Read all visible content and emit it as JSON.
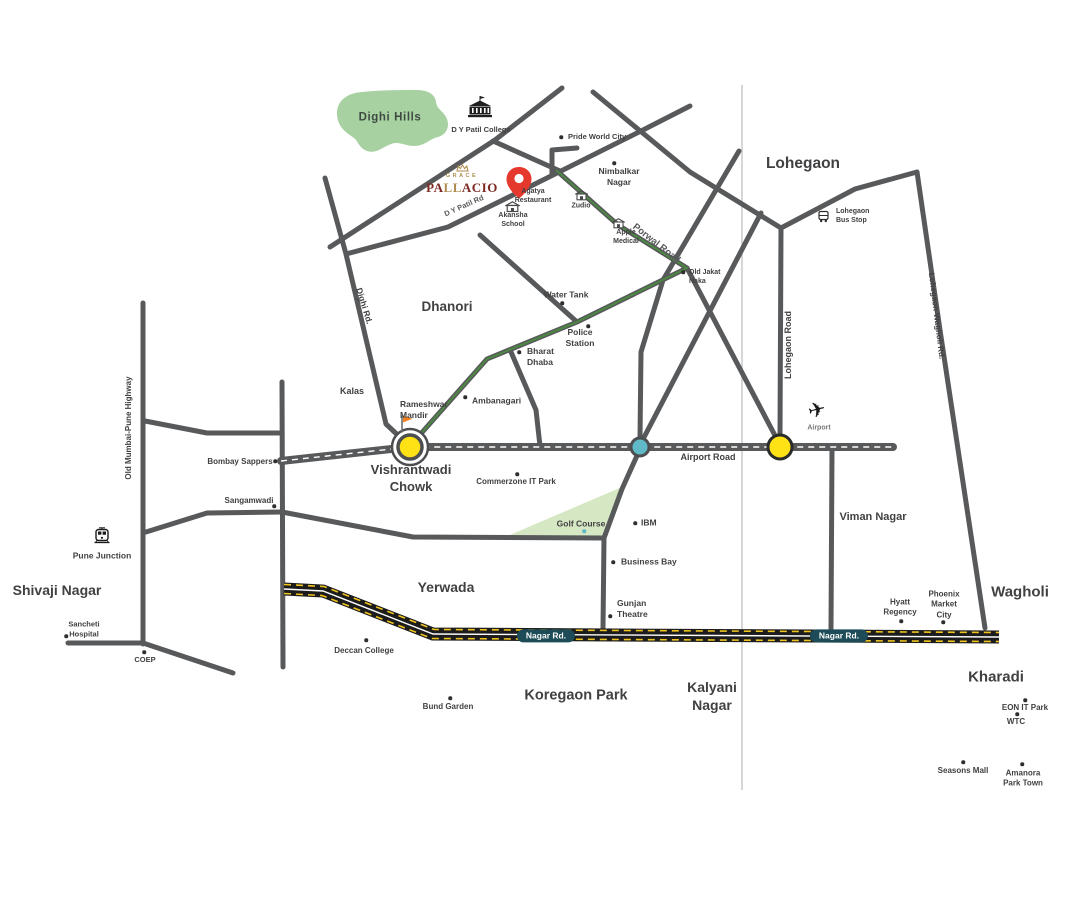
{
  "map": {
    "theme": {
      "road": "#58595b",
      "ink": "#414042",
      "green": "#4a8c3f",
      "hills": "#a8d1a2",
      "golf": "#d5e7c3",
      "yellow": "#ffe215",
      "teal": "#5fb9c6",
      "hwy": "#1c1c1c",
      "hwyellow": "#efc41c",
      "badge": "#1d4b57",
      "pin": "#e6392e",
      "flag": "#f5821f",
      "maroon": "#7d2a24",
      "gold": "#a98e4e"
    },
    "logo": {
      "top": "GRACE",
      "p1": "PA",
      "p2": "LL",
      "p3": "ACIO"
    },
    "labels": [
      {
        "id": "dighi-hills",
        "t": "Dighi Hills",
        "x": 390,
        "y": 118,
        "fz": 11.5,
        "fw": 700,
        "ls": 0.6,
        "c": "#3e4b42"
      },
      {
        "id": "lohegaon",
        "t": "Lohegaon",
        "x": 803,
        "y": 164,
        "fz": 15.5,
        "fw": 600
      },
      {
        "id": "dhanori",
        "t": "Dhanori",
        "x": 447,
        "y": 307,
        "fz": 13.5,
        "fw": 600
      },
      {
        "id": "vishrantwadi-chowk",
        "t": "Vishrantwadi\nChowk",
        "x": 411,
        "y": 479,
        "fz": 13,
        "fw": 700
      },
      {
        "id": "viman-nagar",
        "t": "Viman Nagar",
        "x": 873,
        "y": 517,
        "fz": 11,
        "fw": 700
      },
      {
        "id": "shivaji-nagar",
        "t": "Shivaji Nagar",
        "x": 57,
        "y": 590,
        "fz": 14,
        "fw": 600
      },
      {
        "id": "yerwada",
        "t": "Yerwada",
        "x": 446,
        "y": 587,
        "fz": 14,
        "fw": 600
      },
      {
        "id": "wagholi",
        "t": "Wagholi",
        "x": 1020,
        "y": 592,
        "fz": 15,
        "fw": 600
      },
      {
        "id": "koregaon-park",
        "t": "Koregaon Park",
        "x": 576,
        "y": 696,
        "fz": 14.5,
        "fw": 600
      },
      {
        "id": "kalyani-nagar",
        "t": "Kalyani\nNagar",
        "x": 712,
        "y": 696,
        "fz": 14,
        "fw": 600
      },
      {
        "id": "kharadi",
        "t": "Kharadi",
        "x": 996,
        "y": 677,
        "fz": 15,
        "fw": 600
      },
      {
        "id": "dy-patil-college",
        "t": "D Y Patil College",
        "x": 481,
        "y": 130,
        "fz": 7.5,
        "fw": 600
      },
      {
        "id": "pride-world-city",
        "t": "Pride World City",
        "x": 568,
        "y": 137,
        "fz": 7.5,
        "fw": 600,
        "a": "l",
        "dot": [
          561,
          137
        ]
      },
      {
        "id": "nimbalkar-nagar",
        "t": "Nimbalkar\nNagar",
        "x": 619,
        "y": 177,
        "fz": 8.5,
        "fw": 600,
        "dot": [
          614,
          163
        ]
      },
      {
        "id": "agatya-restaurant",
        "t": "Agatya\nRestaurant",
        "x": 533,
        "y": 196,
        "fz": 7,
        "fw": 600
      },
      {
        "id": "akansha-school",
        "t": "Akansha\nSchool",
        "x": 513,
        "y": 220,
        "fz": 7,
        "fw": 600
      },
      {
        "id": "zudio",
        "t": "Zudio",
        "x": 581,
        "y": 206,
        "fz": 7,
        "fw": 600
      },
      {
        "id": "apple-medical",
        "t": "Apple\nMedical",
        "x": 626,
        "y": 237,
        "fz": 7,
        "fw": 600
      },
      {
        "id": "lohegaon-bus-stop",
        "t": "Lohegaon\nBus Stop",
        "x": 836,
        "y": 216,
        "fz": 7,
        "fw": 600,
        "a": "l"
      },
      {
        "id": "old-jakat-naka",
        "t": "Old Jakat\nNaka",
        "x": 689,
        "y": 277,
        "fz": 7,
        "fw": 600,
        "a": "l",
        "dot": [
          683,
          272
        ]
      },
      {
        "id": "water-tank",
        "t": "Water Tank",
        "x": 566,
        "y": 295,
        "fz": 8.5,
        "fw": 600,
        "dot": [
          562,
          303
        ]
      },
      {
        "id": "police-station",
        "t": "Police\nStation",
        "x": 580,
        "y": 338,
        "fz": 8.5,
        "fw": 600,
        "dot": [
          588,
          326
        ]
      },
      {
        "id": "bharat-dhaba",
        "t": "Bharat\nDhaba",
        "x": 527,
        "y": 357,
        "fz": 8.5,
        "fw": 600,
        "a": "l",
        "dot": [
          519,
          352
        ]
      },
      {
        "id": "ambanagari",
        "t": "Ambanagari",
        "x": 472,
        "y": 401,
        "fz": 8.5,
        "fw": 600,
        "a": "l",
        "dot": [
          465,
          397
        ]
      },
      {
        "id": "rameshwar-mandir",
        "t": "Rameshwar\nMandir",
        "x": 400,
        "y": 410,
        "fz": 8.5,
        "fw": 600,
        "a": "l"
      },
      {
        "id": "kalas",
        "t": "Kalas",
        "x": 352,
        "y": 392,
        "fz": 9,
        "fw": 600
      },
      {
        "id": "bombay-sappers",
        "t": "Bombay Sappers",
        "x": 240,
        "y": 462,
        "fz": 8,
        "fw": 600,
        "dot": [
          275,
          461
        ]
      },
      {
        "id": "sangamwadi",
        "t": "Sangamwadi",
        "x": 249,
        "y": 501,
        "fz": 8,
        "fw": 600,
        "dot": [
          274,
          506
        ]
      },
      {
        "id": "pune-junction",
        "t": "Pune Junction",
        "x": 102,
        "y": 556,
        "fz": 8.5,
        "fw": 700
      },
      {
        "id": "sancheti-hospital",
        "t": "Sancheti\nHospital",
        "x": 84,
        "y": 629,
        "fz": 7.5,
        "fw": 600,
        "dot": [
          66,
          636
        ]
      },
      {
        "id": "coep",
        "t": "COEP",
        "x": 145,
        "y": 660,
        "fz": 7.5,
        "fw": 600,
        "dot": [
          144,
          652
        ]
      },
      {
        "id": "commerzone-it-park",
        "t": "Commerzone IT Park",
        "x": 516,
        "y": 482,
        "fz": 8,
        "fw": 600,
        "dot": [
          517,
          474
        ]
      },
      {
        "id": "golf-course",
        "t": "Golf Course",
        "x": 581,
        "y": 524,
        "fz": 8.5,
        "fw": 600,
        "dot": [
          584,
          531
        ],
        "dc": "#5fb9c6"
      },
      {
        "id": "ibm",
        "t": "IBM",
        "x": 641,
        "y": 523,
        "fz": 8.5,
        "fw": 600,
        "a": "l",
        "dot": [
          635,
          523
        ]
      },
      {
        "id": "business-bay",
        "t": "Business Bay",
        "x": 621,
        "y": 562,
        "fz": 8.5,
        "fw": 600,
        "a": "l",
        "dot": [
          613,
          562
        ]
      },
      {
        "id": "gunjan-theatre",
        "t": "Gunjan\nTheatre",
        "x": 617,
        "y": 609,
        "fz": 8.5,
        "fw": 600,
        "a": "l",
        "dot": [
          610,
          616
        ]
      },
      {
        "id": "airport",
        "t": "Airport",
        "x": 819,
        "y": 428,
        "fz": 7,
        "fw": 600,
        "c": "#77787b"
      },
      {
        "id": "hyatt-regency",
        "t": "Hyatt\nRegency",
        "x": 900,
        "y": 608,
        "fz": 8,
        "fw": 600,
        "dot": [
          901,
          621
        ]
      },
      {
        "id": "phoenix-market-city",
        "t": "Phoenix\nMarket\nCity",
        "x": 944,
        "y": 605,
        "fz": 8,
        "fw": 600,
        "dot": [
          943,
          622
        ]
      },
      {
        "id": "deccan-college",
        "t": "Deccan College",
        "x": 364,
        "y": 651,
        "fz": 8,
        "fw": 600,
        "dot": [
          366,
          640
        ]
      },
      {
        "id": "bund-garden",
        "t": "Bund Garden",
        "x": 448,
        "y": 707,
        "fz": 8,
        "fw": 600,
        "dot": [
          450,
          698
        ]
      },
      {
        "id": "eon-it-park",
        "t": "EON IT Park",
        "x": 1025,
        "y": 708,
        "fz": 8,
        "fw": 600,
        "dot": [
          1025,
          700
        ]
      },
      {
        "id": "wtc",
        "t": "WTC",
        "x": 1016,
        "y": 722,
        "fz": 8,
        "fw": 600,
        "dot": [
          1017,
          714
        ]
      },
      {
        "id": "seasons-mall",
        "t": "Seasons Mall",
        "x": 963,
        "y": 771,
        "fz": 8,
        "fw": 600,
        "dot": [
          963,
          762
        ]
      },
      {
        "id": "amanora-park-town",
        "t": "Amanora\nPark Town",
        "x": 1023,
        "y": 779,
        "fz": 8,
        "fw": 600,
        "dot": [
          1022,
          764
        ]
      },
      {
        "id": "road-dy-patil-rd",
        "t": "D Y Patil Rd",
        "x": 464,
        "y": 206,
        "fz": 7.5,
        "fw": 700,
        "rot": -24,
        "c": "#58595b"
      },
      {
        "id": "road-dighi-rd",
        "t": "Dighi Rd.",
        "x": 364,
        "y": 306,
        "fz": 8.5,
        "fw": 700,
        "rot": 73
      },
      {
        "id": "road-porwal",
        "t": "Porwal Road",
        "x": 656,
        "y": 244,
        "fz": 9.5,
        "fw": 700,
        "rot": 38,
        "c": "#58595b"
      },
      {
        "id": "road-airport",
        "t": "Airport Road",
        "x": 708,
        "y": 458,
        "fz": 9,
        "fw": 700
      },
      {
        "id": "road-lohegaon",
        "t": "Lohegaon Road",
        "x": 789,
        "y": 345,
        "fz": 9,
        "fw": 700,
        "rot": -90
      },
      {
        "id": "road-lohegaon-wagholi",
        "t": "Lohegaon-Wagholi Rd.",
        "x": 936,
        "y": 316,
        "fz": 8,
        "fw": 600,
        "rot": 83
      },
      {
        "id": "road-old-mumbai",
        "t": "Old Mumbai-Pune Highway",
        "x": 129,
        "y": 428,
        "fz": 8,
        "fw": 700,
        "rot": -90
      },
      {
        "id": "badge-nagar-rd-1",
        "t": "Nagar Rd.",
        "x": 546,
        "y": 636,
        "fz": 8.5,
        "fw": 700,
        "bg": "#1d4b57",
        "c": "#ffffff"
      },
      {
        "id": "badge-nagar-rd-2",
        "t": "Nagar Rd.",
        "x": 839,
        "y": 636,
        "fz": 8.5,
        "fw": 700,
        "bg": "#1d4b57",
        "c": "#ffffff"
      }
    ]
  }
}
